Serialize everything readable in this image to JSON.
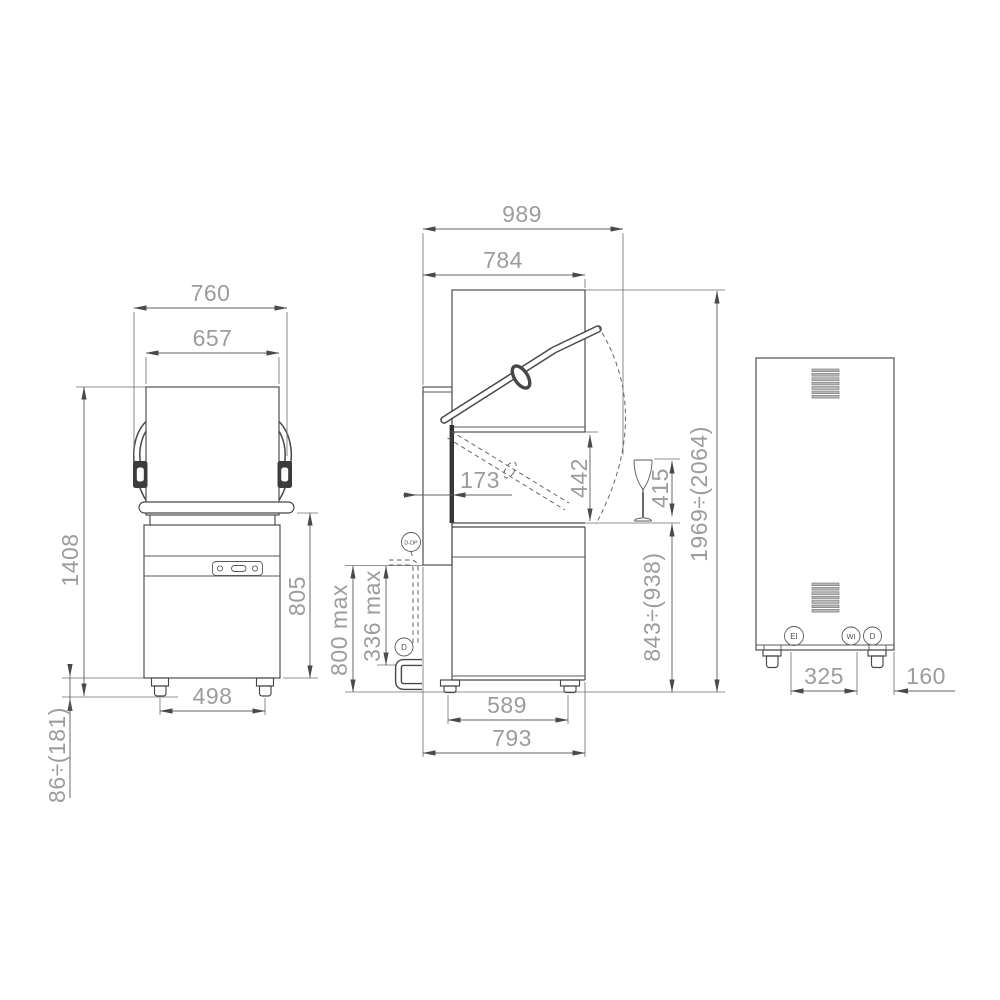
{
  "views": {
    "front": {
      "width_overall": "760",
      "width_hood": "657",
      "height_total": "1408",
      "height_body": "805",
      "feet_span": "498",
      "feet_height_range": "86÷(181)"
    },
    "side": {
      "depth_overall": "989",
      "depth_hood": "784",
      "rear_offset": "173",
      "opening_height": "442",
      "glass_max_height": "415",
      "height_open_range": "1969÷(2064)",
      "height_hood_range": "843÷(938)",
      "drain_height_max": "800 max",
      "drain_run_max": "336 max",
      "feet_span": "589",
      "base_depth": "793",
      "connection_ddp": "D-DP",
      "connection_d": "D"
    },
    "back": {
      "connections_span": "325",
      "edge_clearance": "160",
      "connection_ei": "EI",
      "connection_wi": "WI",
      "connection_d": "D"
    }
  },
  "colors": {
    "machine_line": "#474747",
    "dimension_text": "#9c9c9c",
    "background": "#ffffff"
  }
}
